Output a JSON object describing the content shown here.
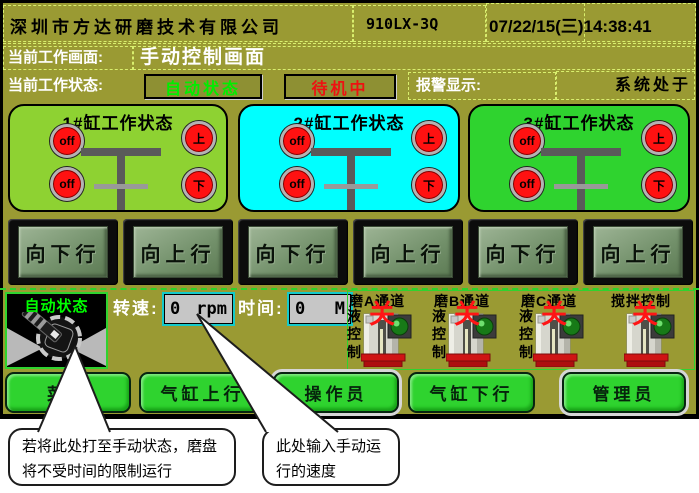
{
  "header": {
    "company": "深圳市方达研磨技术有限公司",
    "model": "910LX-3Q",
    "datetime": "07/22/15(三)14:38:41"
  },
  "info": {
    "screen_label": "当前工作画面:",
    "screen_name": "手动控制画面",
    "state_label": "当前工作状态:",
    "auto_state": "自动状态",
    "standby_state": "待机中",
    "alarm_label": "报警显示:",
    "alarm_text": "系统处于"
  },
  "cylinders": [
    {
      "title": "1#缸工作状态",
      "lights": [
        "off",
        "off",
        "上",
        "下"
      ]
    },
    {
      "title": "2#缸工作状态",
      "lights": [
        "off",
        "off",
        "上",
        "下"
      ]
    },
    {
      "title": "3#缸工作状态",
      "lights": [
        "off",
        "off",
        "上",
        "下"
      ]
    }
  ],
  "motion_buttons": [
    "向下行",
    "向上行",
    "向下行",
    "向上行",
    "向下行",
    "向上行"
  ],
  "manual": {
    "knob_state": "自动状态",
    "speed_label": "转速:",
    "speed_value": "0",
    "speed_unit": "rpm",
    "time_label": "时间:",
    "time_value": "0",
    "time_unit": "M"
  },
  "valves": [
    {
      "title": "磨A通道",
      "side": "液控制",
      "state": "关"
    },
    {
      "title": "磨B通道",
      "side": "液控制",
      "state": "关"
    },
    {
      "title": "磨C通道",
      "side": "液控制",
      "state": "关"
    },
    {
      "title": "搅拌控制",
      "side": "",
      "state": "关"
    }
  ],
  "bottom_buttons": [
    "菜单",
    "气缸上行",
    "操作员",
    "气缸下行",
    "管理员"
  ],
  "callouts": [
    {
      "text": "若将此处打至手动状态，磨盘将不受时间的限制运行"
    },
    {
      "text": "此处输入手动运行的速度"
    }
  ],
  "colors": {
    "screen_bg": "#9a9a33",
    "panel1_bg": "#8ed232",
    "panel2_bg": "#00ffff",
    "panel3_bg": "#2fd32f",
    "indicator_red": "#ff1111",
    "auto_state_text": "#00ee00",
    "standby_state_text": "#ee1111",
    "bottom_button_green": "#2fd32f",
    "valve_state_red": "#ff1515",
    "dashed_border": "#d9ef6e"
  }
}
